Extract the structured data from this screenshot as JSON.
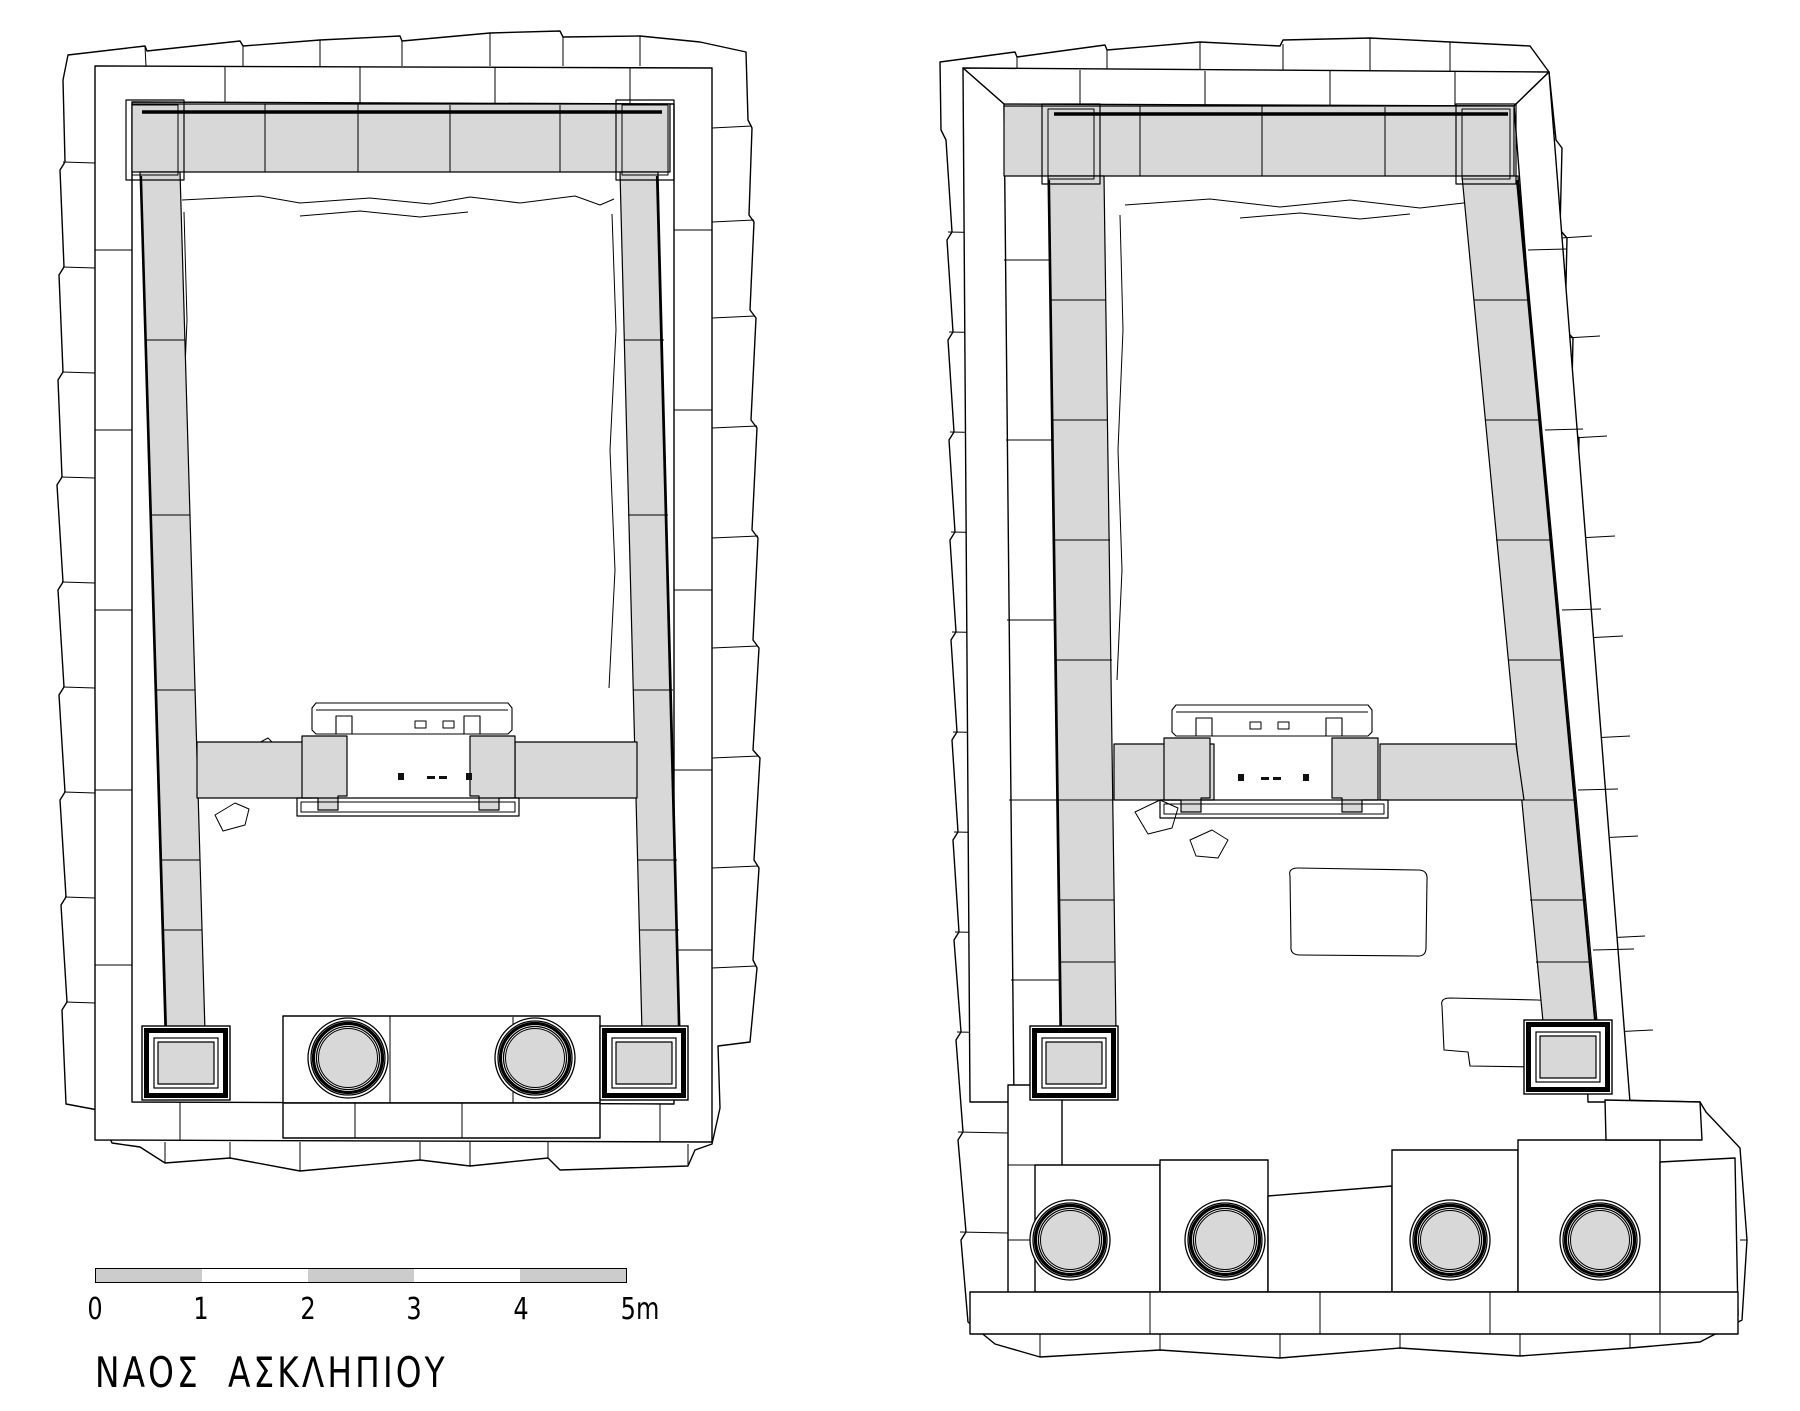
{
  "title": "ΝΑΟΣ  ΑΣΚΛΗΠΙΟΥ",
  "scale_bar": {
    "tick_labels": [
      "0",
      "1",
      "2",
      "3",
      "4",
      "5m"
    ],
    "segment_fills": [
      "#cccccc",
      "#ffffff",
      "#cccccc",
      "#ffffff",
      "#cccccc"
    ],
    "meters_total": 5
  },
  "colors": {
    "background": "#ffffff",
    "stone_fill": "#d8d8d8",
    "scale_gray": "#cccccc",
    "line": "#000000",
    "dark_frame": "#111111"
  },
  "plans": [
    {
      "name": "left-temple-plan",
      "porch_columns": 2,
      "antae": 2,
      "door_openings": 1
    },
    {
      "name": "right-temple-plan",
      "porch_columns": 4,
      "antae": 2,
      "door_openings": 1
    }
  ]
}
